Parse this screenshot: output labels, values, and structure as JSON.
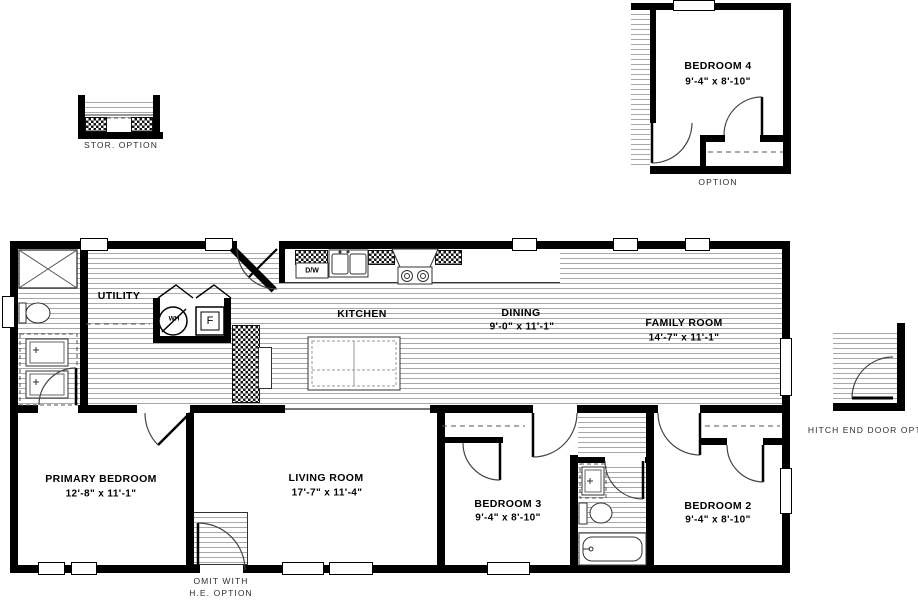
{
  "title": "Floor plan",
  "colors": {
    "wall": "#000000",
    "floor_line": "#a8a8a8",
    "label_ink": "#000000",
    "annotation_ink": "#2e2e2e"
  },
  "rooms": {
    "utility": {
      "name": "UTILITY"
    },
    "kitchen": {
      "name": "KITCHEN"
    },
    "dining": {
      "name": "DINING",
      "dims": "9'-0\" x  11'-1\""
    },
    "family": {
      "name": "FAMILY ROOM",
      "dims": "14'-7\" x  11'-1\""
    },
    "primary": {
      "name": "PRIMARY BEDROOM",
      "dims": "12'-8\" x  11'-1\""
    },
    "living": {
      "name": "LIVING ROOM",
      "dims": "17'-7\" x  11'-4\""
    },
    "bedroom3": {
      "name": "BEDROOM 3",
      "dims": "9'-4\" x  8'-10\""
    },
    "bedroom2": {
      "name": "BEDROOM 2",
      "dims": "9'-4\" x  8'-10\""
    }
  },
  "details": {
    "stor_option": {
      "label": "STOR.  OPTION"
    },
    "bedroom4_option": {
      "name": "BEDROOM 4",
      "dims": "9'-4\" x  8'-10\"",
      "label": "OPTION"
    },
    "hitch_option": {
      "label": "HITCH  END  DOOR  OPT."
    },
    "he_option": {
      "line1": "OMIT  WITH",
      "line2": "H.E.  OPTION"
    }
  },
  "fixtures": {
    "dishwasher": "D/W",
    "water_heater": "WH",
    "furnace": "F"
  }
}
